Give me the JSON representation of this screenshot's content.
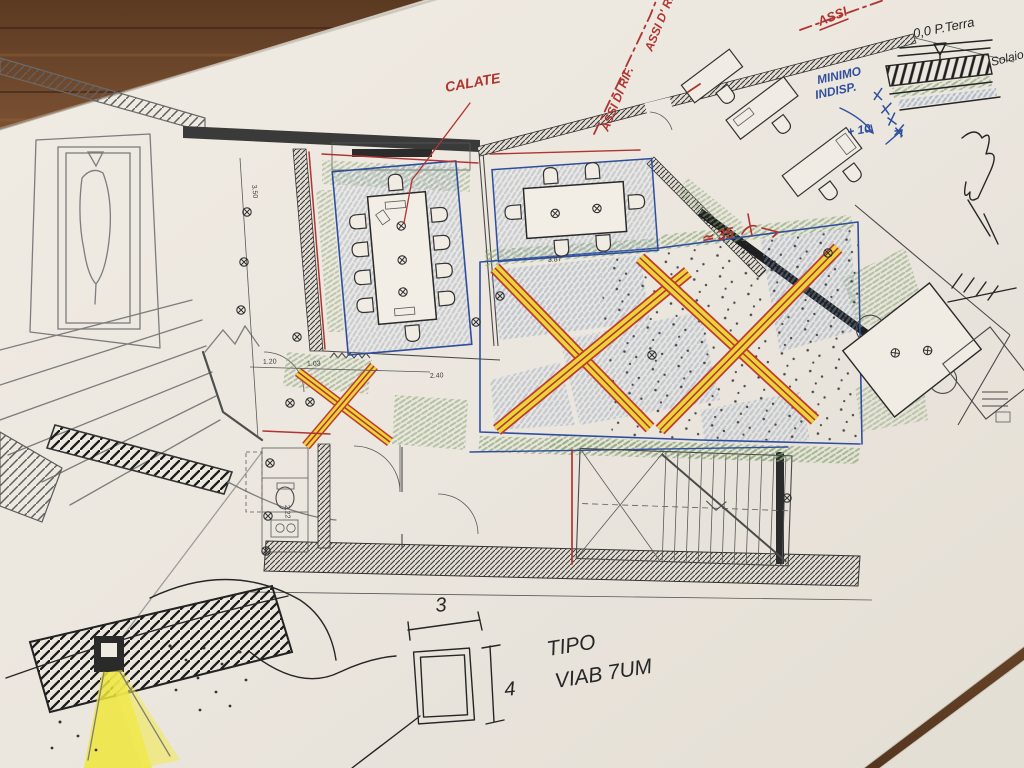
{
  "labels": {
    "axis_ref_1": "ASSI DI RIF.",
    "axis_ref_2": "ASSI D' RIF.",
    "axis_ref_3": "ASSI",
    "calate": "CALATE",
    "circa_35": "≃ 35",
    "minimo_line1": "MINIMO",
    "minimo_line2": "INDISP.",
    "plus_10": "+ 10",
    "level_zero": "0,0 P.Terra",
    "solaio": "Solaio",
    "tipo_line1": "TIPO",
    "tipo_line2": "VIAB 7UM",
    "col_width": "3",
    "col_height": "4"
  },
  "dimensions": {
    "hall_width": "3.87",
    "left_height": "3.50",
    "corridor": "2.40",
    "door_a": "1.20",
    "door_b": "1.03",
    "bath_height": "2.22"
  },
  "colors": {
    "red_pen": "#b03430",
    "blue_pen": "#2f4f9e",
    "green_pencil": "#8aa878",
    "blue_pencil": "#7f9cc4",
    "yellow_highlighter": "#efe63b",
    "ink": "#262626",
    "graphite": "#7d7d7d",
    "paper": "#ece7df",
    "wood": "#6b4527"
  }
}
